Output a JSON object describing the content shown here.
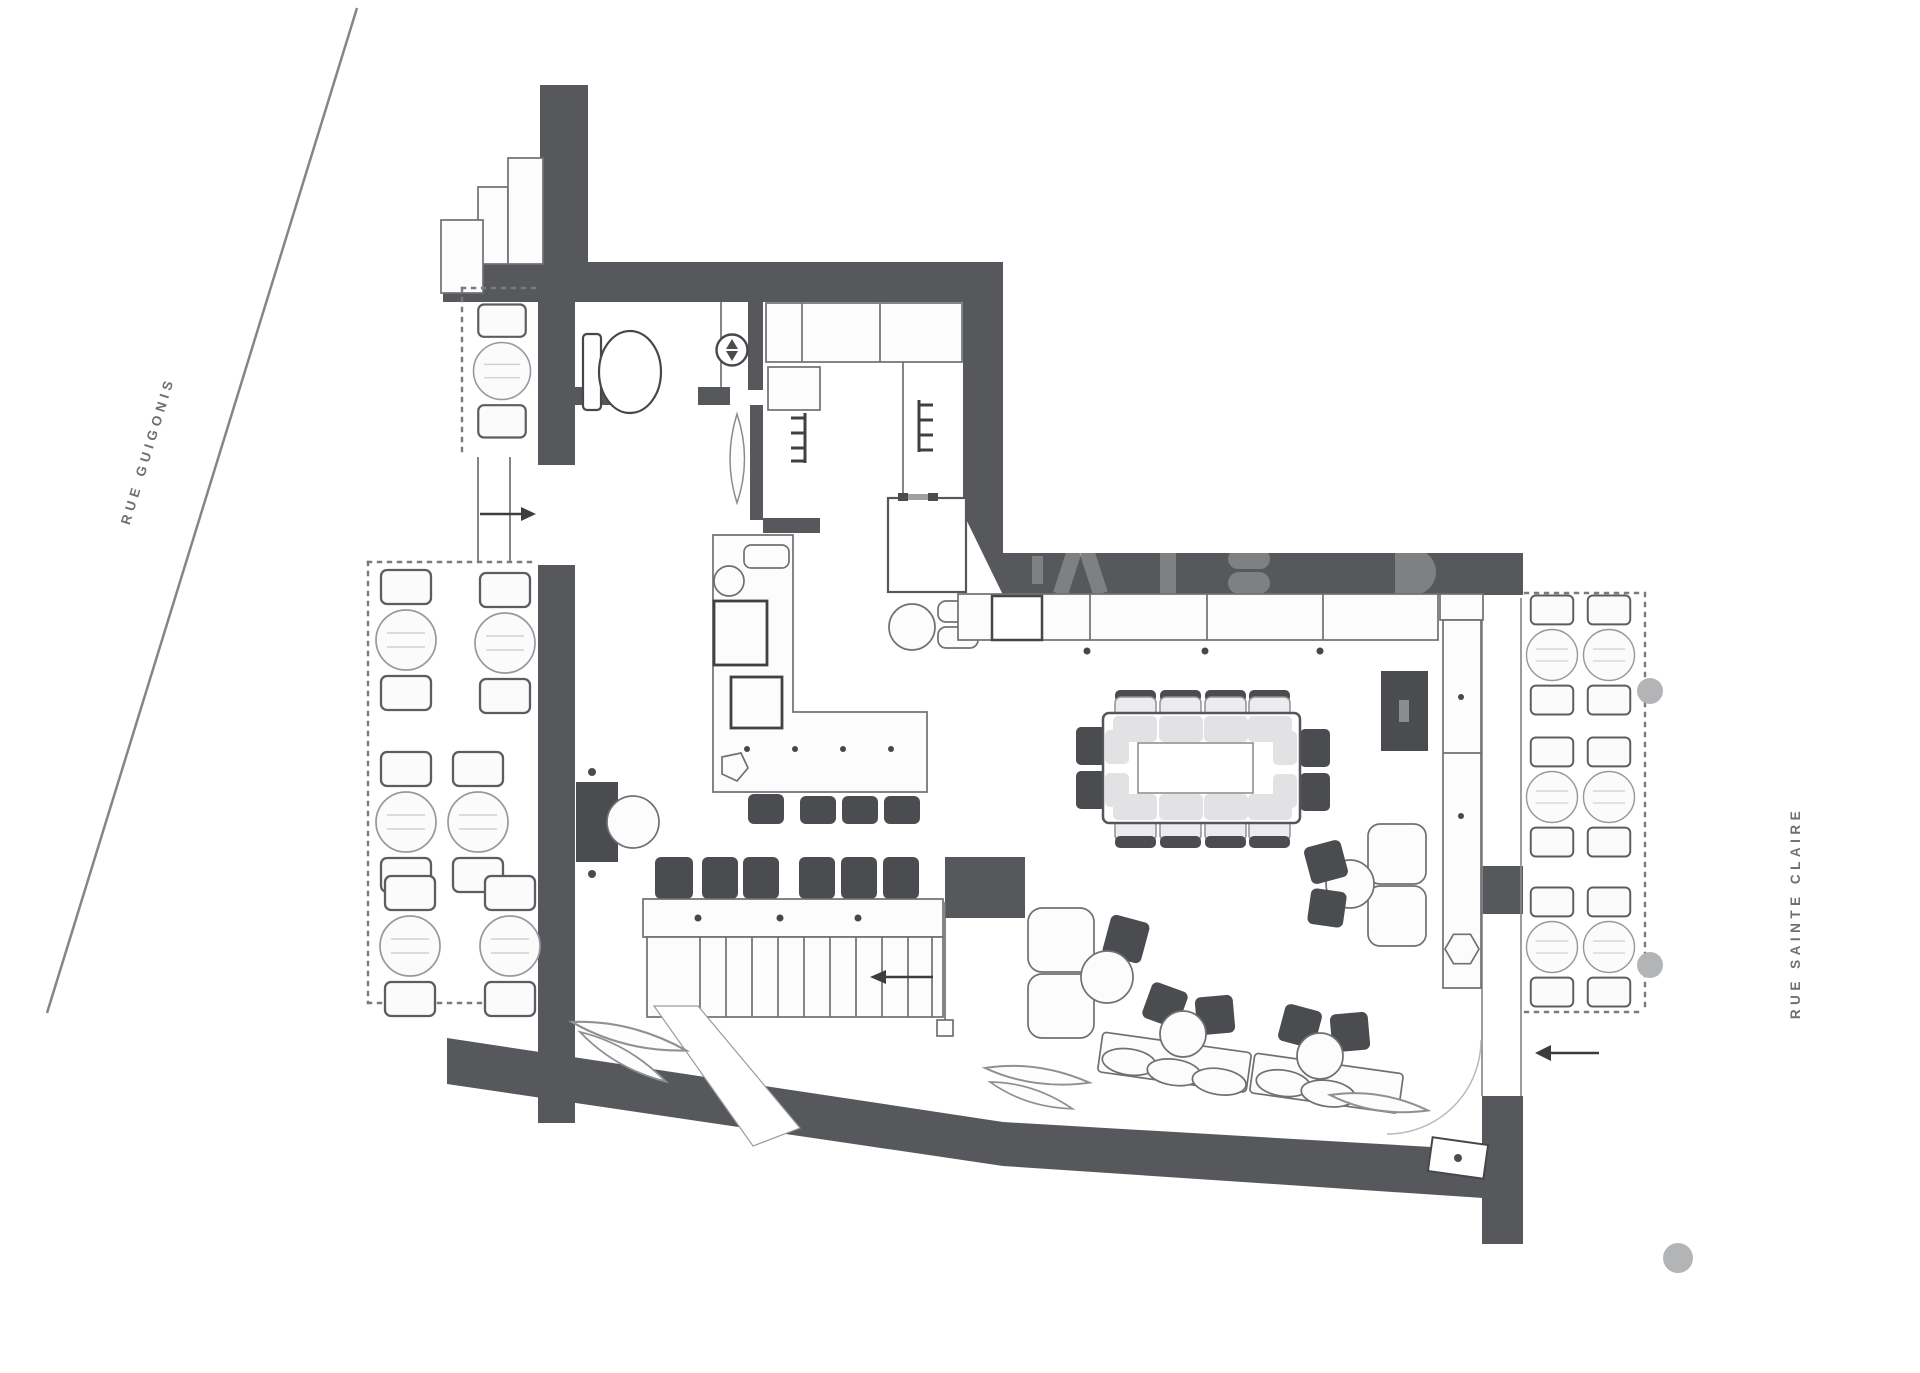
{
  "streets": {
    "left": "RUE GUIGONIS",
    "right": "RUE SAINTE CLAIRE"
  },
  "colors": {
    "wall": "#57585b",
    "line": "#6f7073",
    "dark_furniture": "#4b4c4f",
    "light_gray": "#b3b4b6",
    "dotted_boundary": "#7a7b7e",
    "background": "#ffffff"
  },
  "icons": {
    "left_entry": "arrow-right-icon",
    "right_entry": "arrow-left-icon",
    "stairs_direction": "arrow-left-icon",
    "water_heater_valve": "double-triangle-icon"
  }
}
